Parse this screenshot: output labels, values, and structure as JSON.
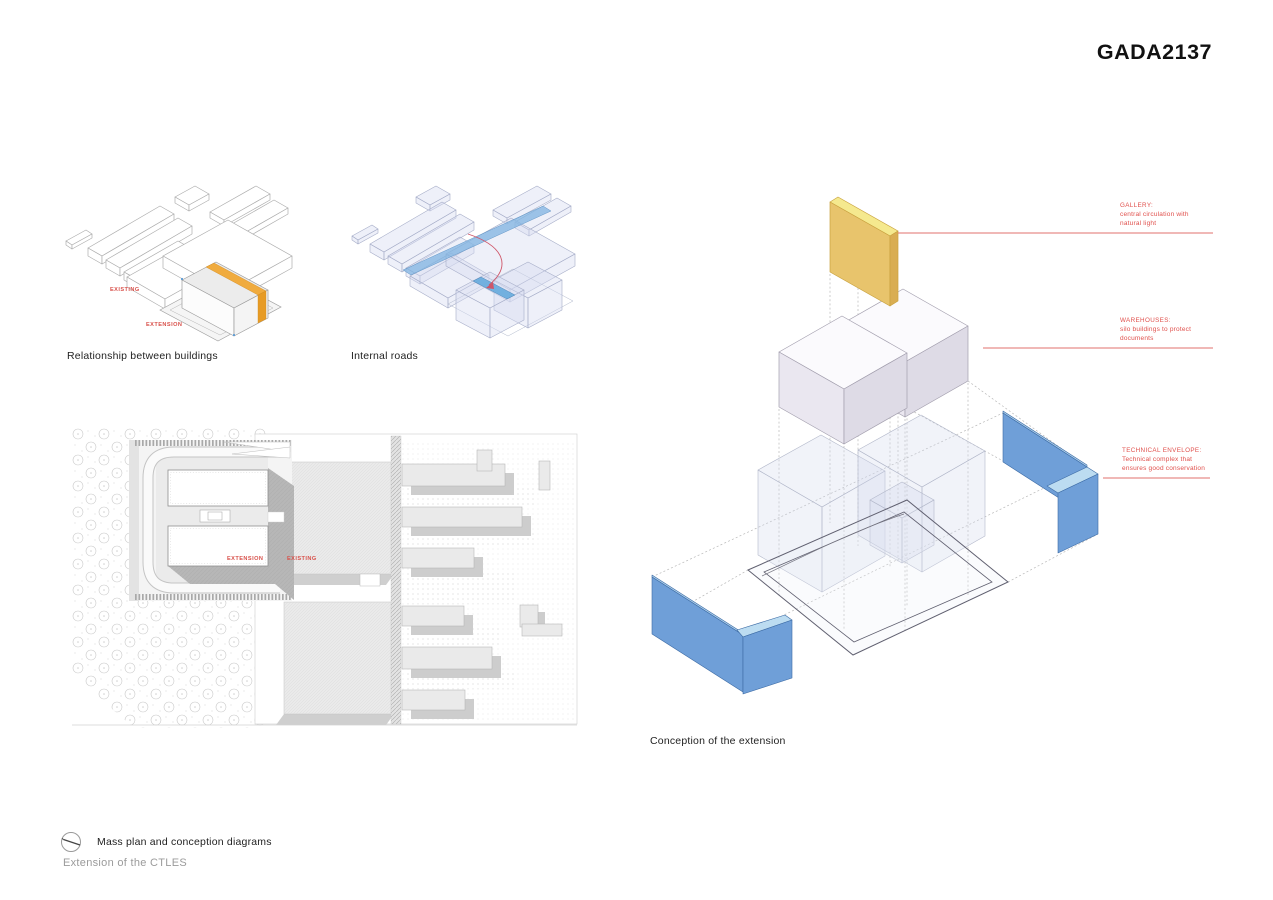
{
  "page": {
    "title": "GADA2137"
  },
  "figures": {
    "relationship": {
      "caption": "Relationship between buildings",
      "labels": {
        "existing": "EXISTING",
        "extension": "EXTENSION"
      }
    },
    "internal_roads": {
      "caption": "Internal roads"
    },
    "site_plan": {
      "labels": {
        "extension": "EXTENSION",
        "existing": "EXISTING"
      }
    },
    "conception": {
      "caption": "Conception of the extension"
    }
  },
  "annotations": {
    "gallery": {
      "heading": "GALLERY:",
      "body": "central circulation with natural light"
    },
    "warehouses": {
      "heading": "WAREHOUSES:",
      "body": "silo buildings to protect documents"
    },
    "technical": {
      "heading": "TECHNICAL ENVELOPE:",
      "body": "Technical complex that ensures good conservation"
    }
  },
  "footer": {
    "subtitle": "Mass plan and conception diagrams",
    "project": "Extension of the CTLES",
    "north_icon": "north-arrow-icon"
  },
  "colors": {
    "annotation_red": "#E0504C",
    "gallery_yellow": "#ECC96D",
    "envelope_blue": "#6F9FD8",
    "road_blue": "#7FB3E0",
    "extension_orange": "#EFA93E"
  }
}
